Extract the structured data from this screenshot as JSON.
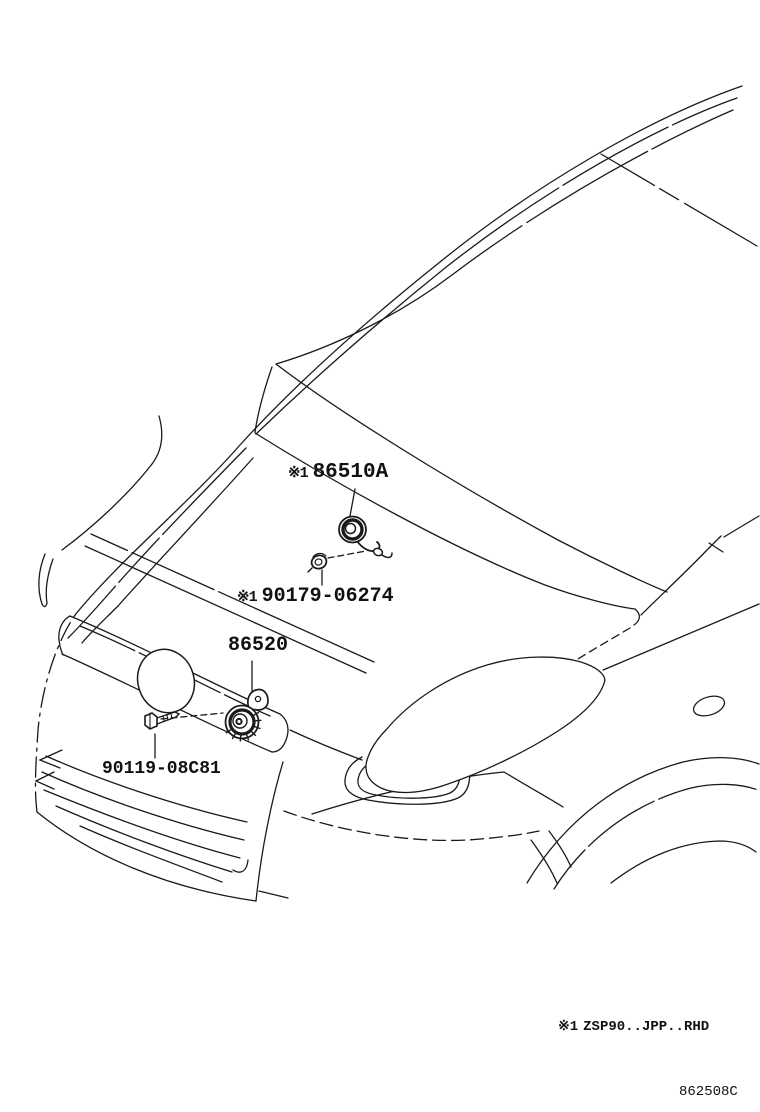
{
  "diagram": {
    "code": "862508C",
    "footnote": {
      "prefix": "※1",
      "text": "ZSP90..JPP..RHD"
    },
    "callouts": [
      {
        "prefix": "※1",
        "label": "86510A"
      },
      {
        "prefix": "※1",
        "label": "90179-06274"
      },
      {
        "prefix": "",
        "label": "86520"
      },
      {
        "prefix": "",
        "label": "90119-08C81"
      }
    ]
  },
  "colors": {
    "background": "#ffffff",
    "line": "#1a1a1a"
  }
}
